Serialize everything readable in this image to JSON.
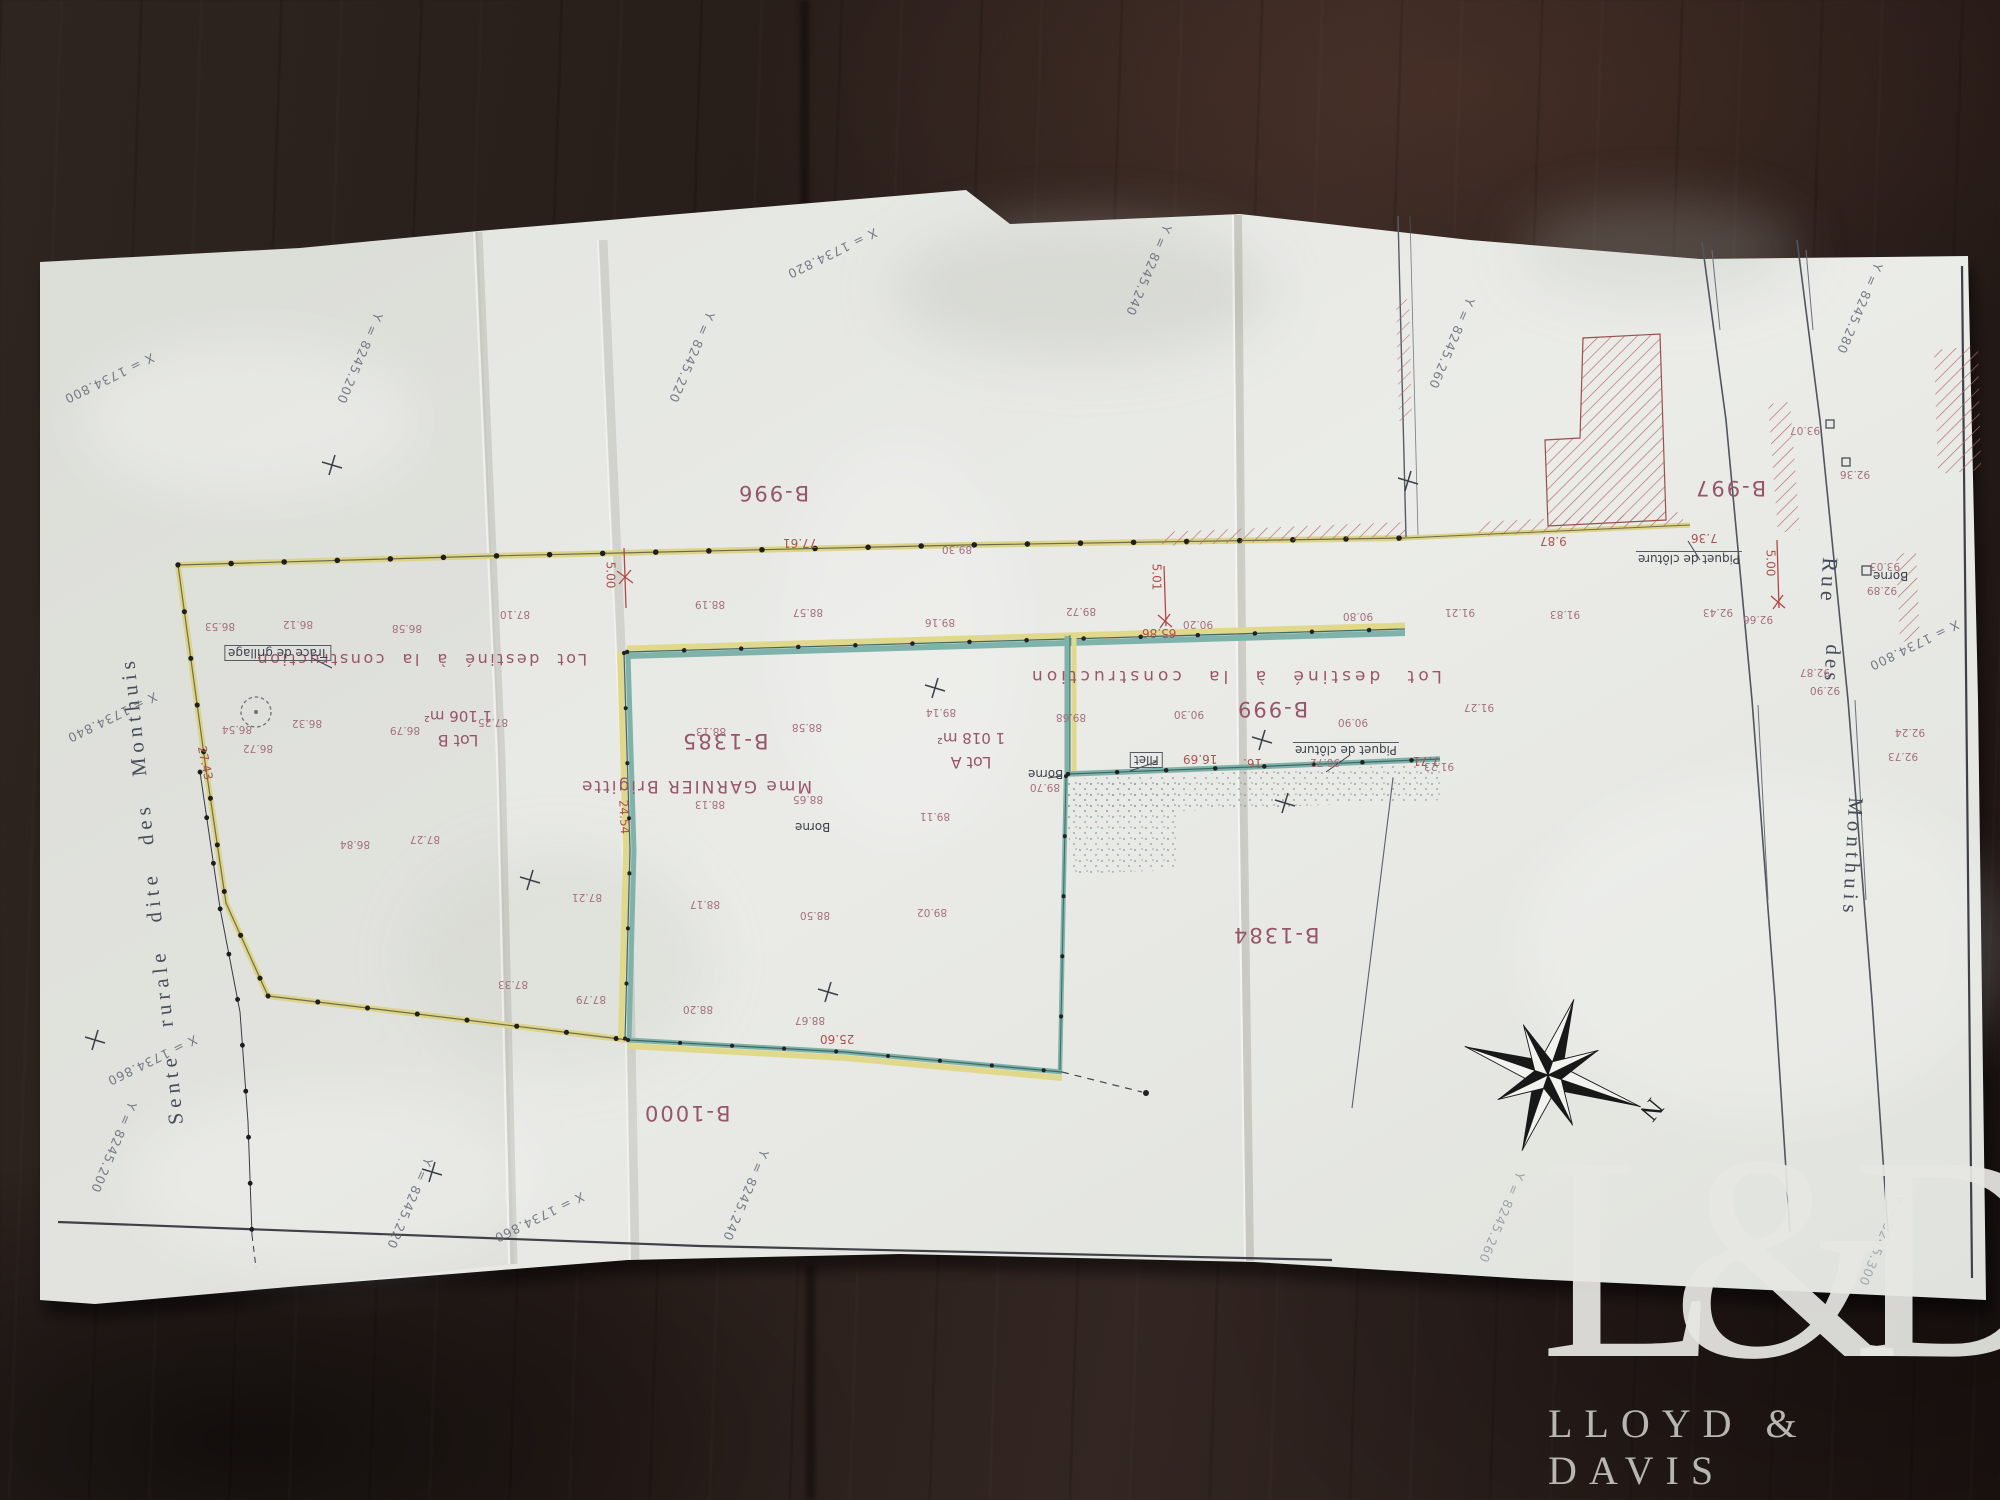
{
  "watermark": {
    "monogram": "L&D",
    "name": "LLOYD & DAVIS"
  },
  "map": {
    "parcels": [
      "B-996",
      "B-997",
      "B-999",
      "B-1000",
      "B-1384",
      "B-1385"
    ],
    "lots": [
      {
        "name": "Lot B",
        "area": "1 106 m²"
      },
      {
        "name": "Lot A",
        "area": "1 018 m²"
      }
    ],
    "owner": "Mme GARNIER Brigitte",
    "zone_label": "Lot destiné à la construction",
    "streets": {
      "left": "Sente rurale dite des Monthuis",
      "right_words": [
        "Rue",
        "des",
        "Monthuis"
      ]
    },
    "features": {
      "borne": "Borne",
      "filet": "Filet",
      "piquet": "Piquet de clôture",
      "trace": "Trace de grillage"
    },
    "compass": {
      "north": "N"
    },
    "measurements": [
      "77.61",
      "5.00",
      "5.01",
      "5.00",
      "65.86",
      "25.60",
      "24.54",
      "27.43",
      "16.69",
      "16.",
      "7.71",
      "7.36",
      "9.87"
    ],
    "elevations": [
      "86.12",
      "86.53",
      "86.58",
      "87.10",
      "89.30",
      "86.79",
      "86.32",
      "87.25",
      "86.54",
      "86.72",
      "87.27",
      "86.84",
      "87.33",
      "87.79",
      "87.21",
      "88.19",
      "88.57",
      "89.16",
      "89.72",
      "90.80",
      "88.13",
      "88.58",
      "89.14",
      "89.68",
      "90.30",
      "90.90",
      "91.27",
      "88.65",
      "88.13",
      "89.11",
      "88.17",
      "88.50",
      "89.02",
      "88.20",
      "88.67",
      "90.72",
      "90.20",
      "89.70",
      "91.23",
      "91.83",
      "91.21",
      "92.43",
      "92.66",
      "93.07",
      "92.36",
      "93.03",
      "92.89",
      "92.87",
      "92.90",
      "92.73",
      "92.24"
    ],
    "grid_labels": [
      "X = 1734.800",
      "Y = 8245.200",
      "X = 1734.820",
      "Y = 8245.220",
      "Y = 8245.240",
      "Y = 8245.260",
      "Y = 8245.280",
      "X = 1734.840",
      "X = 1734.860",
      "Y = 8245.200",
      "Y = 8245.220",
      "X = 1734.860",
      "Y = 8245.240",
      "Y = 8245.260",
      "X = 1734.800",
      "Y = 8245.300"
    ]
  }
}
